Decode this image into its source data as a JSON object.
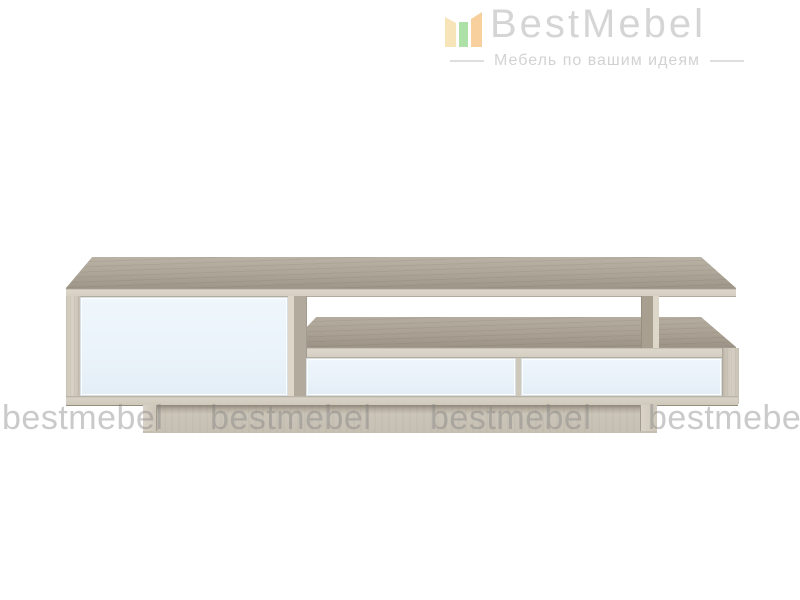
{
  "logo": {
    "brand": "BestMebel",
    "tagline": "Мебель по вашим идеям",
    "brand_color": "#d5d5d5",
    "tagline_color": "#d2d2d2",
    "icon": {
      "name": "bestmebel-bars-icon",
      "bar_colors": [
        "#f7e4b8",
        "#aee1a8",
        "#f8d09e"
      ]
    }
  },
  "watermark": {
    "text": "bestmebel",
    "color": "rgba(128,128,128,0.42)"
  },
  "product": {
    "kind": "tv-stand-render",
    "colors": {
      "wood_top_surface": "#aba293",
      "wood_edge_band": "#d9d3c7",
      "wood_side_panel": "#d6d0c4",
      "facade_white": "#ecf5fb",
      "plinth_wood": "#c8c2b6"
    }
  }
}
